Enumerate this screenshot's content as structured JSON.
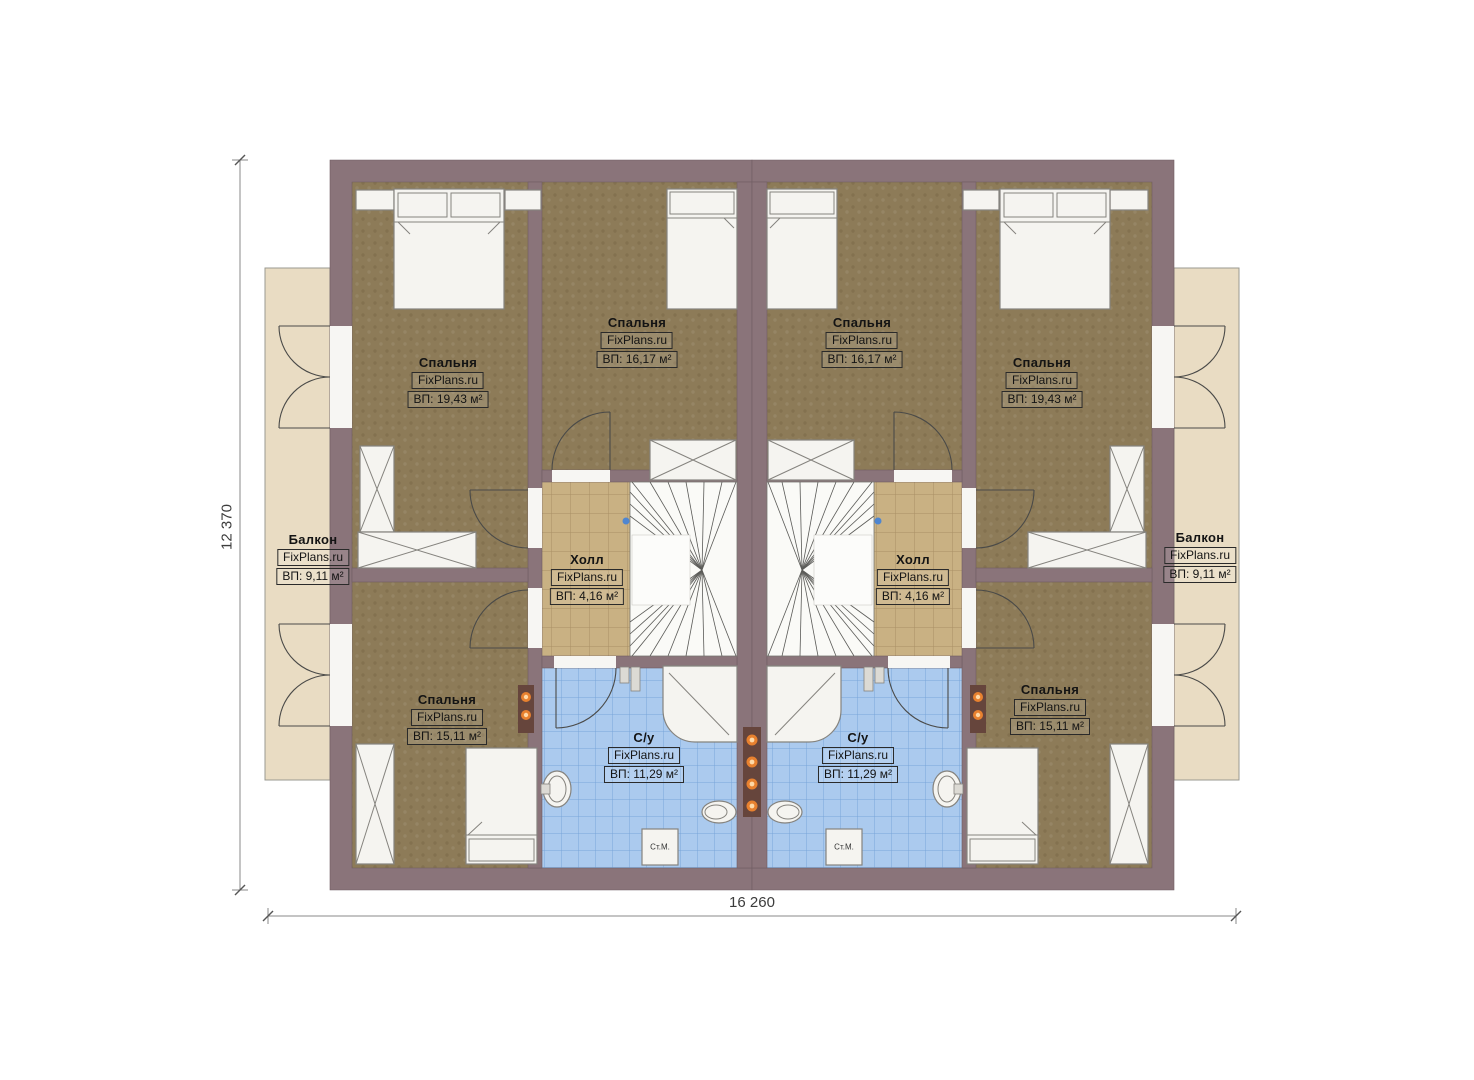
{
  "title": "Floor plan — second floor of a mirrored duplex",
  "watermark": "FixPlans.ru",
  "dimensions": {
    "width_label": "16 260",
    "height_label": "12 370"
  },
  "rooms": {
    "balcony_left": {
      "name": "Балкон",
      "watermark": "FixPlans.ru",
      "area": "ВП: 9,11 м²"
    },
    "bedroom_left_top": {
      "name": "Спальня",
      "watermark": "FixPlans.ru",
      "area": "ВП: 19,43 м²"
    },
    "bedroom_left_inner": {
      "name": "Спальня",
      "watermark": "FixPlans.ru",
      "area": "ВП: 16,17 м²"
    },
    "hall_left": {
      "name": "Холл",
      "watermark": "FixPlans.ru",
      "area": "ВП: 4,16 м²"
    },
    "bath_left": {
      "name": "С/у",
      "watermark": "FixPlans.ru",
      "area": "ВП: 11,29 м²"
    },
    "bedroom_left_bottom": {
      "name": "Спальня",
      "watermark": "FixPlans.ru",
      "area": "ВП: 15,11 м²"
    },
    "bedroom_right_inner": {
      "name": "Спальня",
      "watermark": "FixPlans.ru",
      "area": "ВП: 16,17 м²"
    },
    "bedroom_right_top": {
      "name": "Спальня",
      "watermark": "FixPlans.ru",
      "area": "ВП: 19,43 м²"
    },
    "hall_right": {
      "name": "Холл",
      "watermark": "FixPlans.ru",
      "area": "ВП: 4,16 м²"
    },
    "bath_right": {
      "name": "С/у",
      "watermark": "FixPlans.ru",
      "area": "ВП: 11,29 м²"
    },
    "bedroom_right_bottom": {
      "name": "Спальня",
      "watermark": "FixPlans.ru",
      "area": "ВП: 15,11 м²"
    },
    "balcony_right": {
      "name": "Балкон",
      "watermark": "FixPlans.ru",
      "area": "ВП: 9,11 м²"
    }
  },
  "fixtures": {
    "washing_machine": "Ст.М."
  },
  "colors": {
    "wall": "#8a747a",
    "floor-bedroom": "#8d7b58",
    "floor-hall": "#c9b183",
    "floor-bath": "#abcaee",
    "floor-balcony": "#e9dcc3",
    "fixture": "#f5f4f0",
    "panel": "#66453c",
    "dot": "#e8812f",
    "dim": "#3c3c3c"
  }
}
